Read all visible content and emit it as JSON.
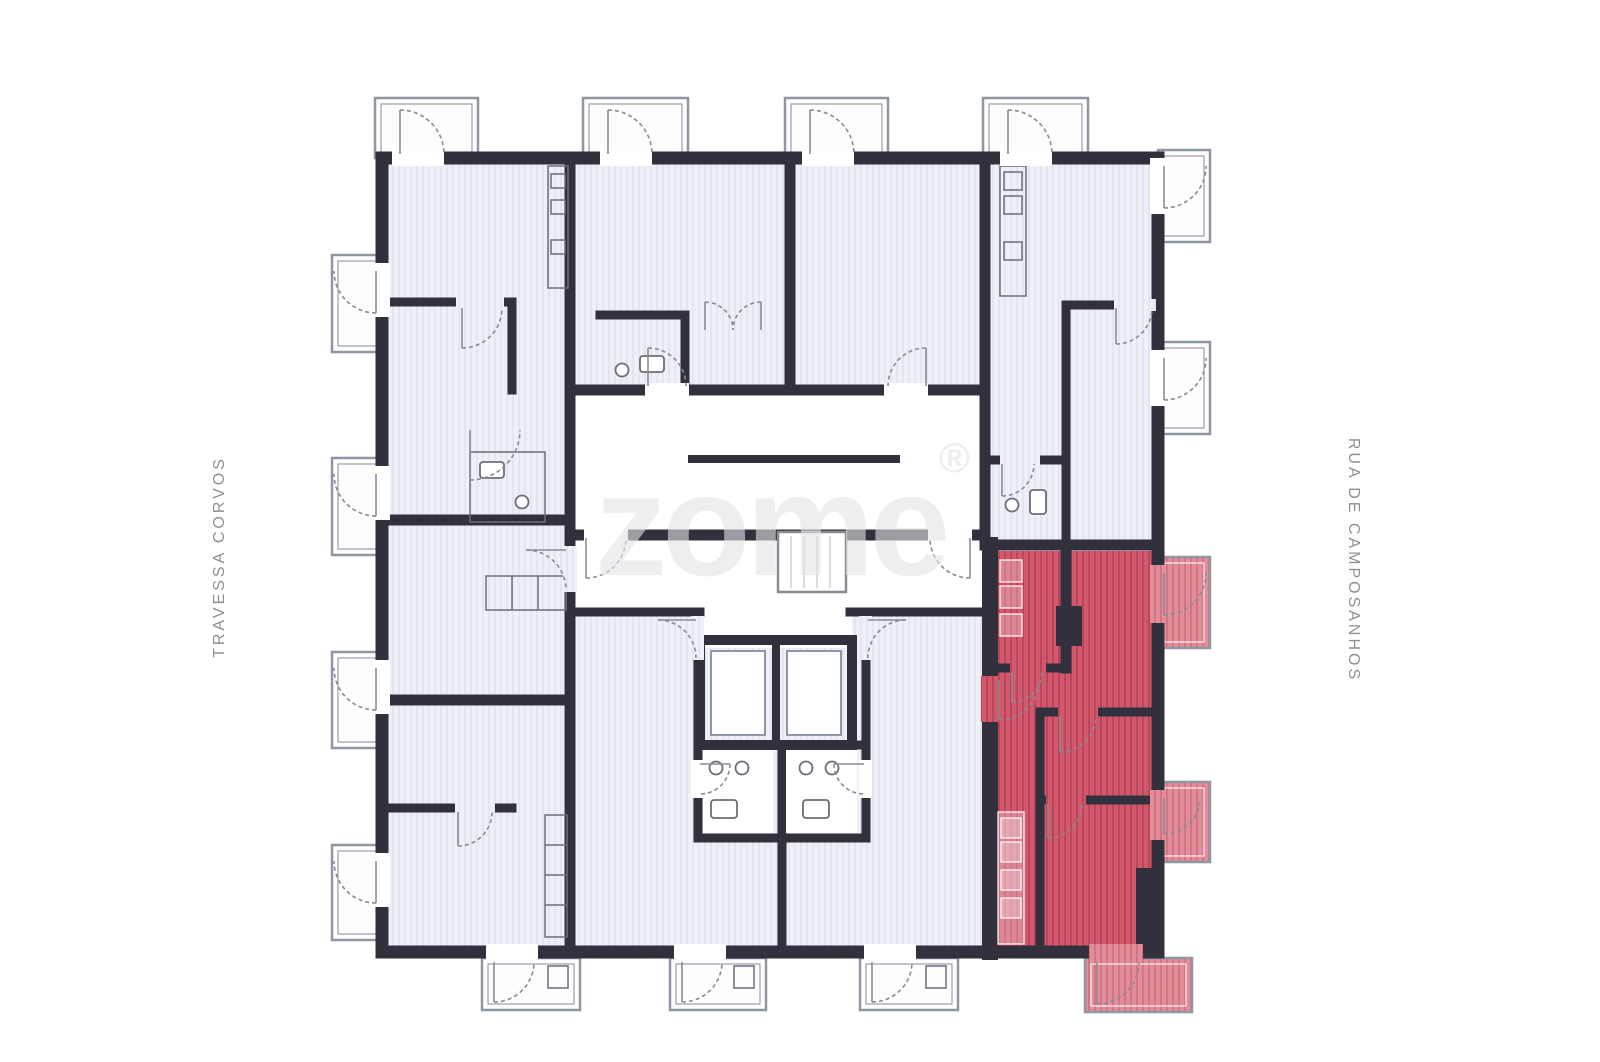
{
  "street_labels": {
    "left": "TRAVESSA CORVOS",
    "right": "RUA DE CAMPOSANHOS"
  },
  "watermark": {
    "brand": "zome",
    "registered_mark": "®"
  },
  "colors": {
    "wall": "#32303d",
    "floor-base": "#eef0f7",
    "floor-hatch": "#dcdfec",
    "red-base": "#d2586b",
    "red-hatch": "#b7415a",
    "red-balcony-base": "#e18d9a",
    "red-balcony-hatch": "#d06f80",
    "outline": "#9096a2",
    "fixture": "#6d6d78",
    "door": "#8a8a93",
    "watermark": "#e4e4e8",
    "street-label": "#8f8f8f",
    "page-bg": "#ffffff"
  }
}
